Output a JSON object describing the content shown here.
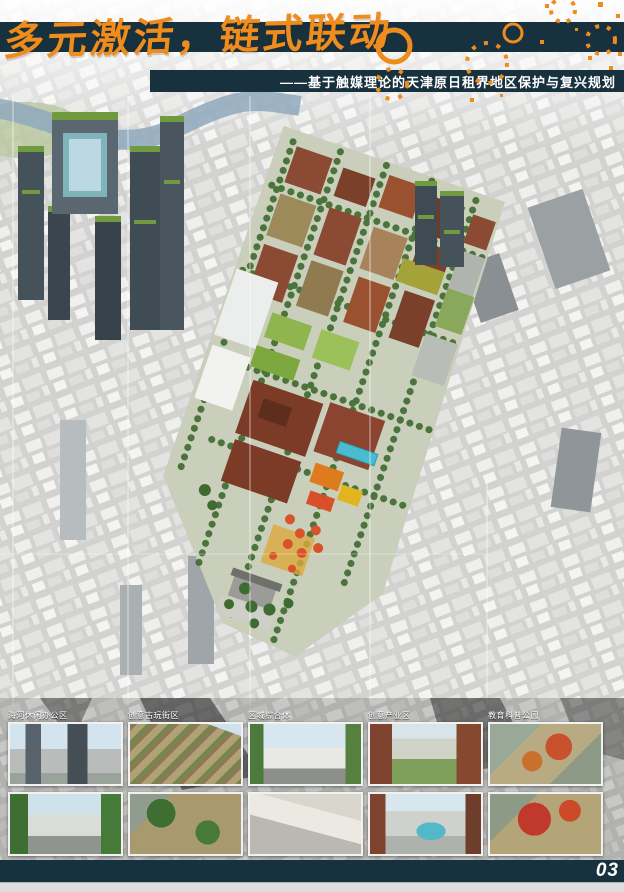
{
  "header": {
    "title": "多元激活，链式联动",
    "subtitle": "——基于触媒理论的天津原日租界地区保护与复兴规划"
  },
  "footer": {
    "page_number": "03"
  },
  "thumbnails": {
    "rows": [
      {
        "items": [
          {
            "label": "海河休闲办公区"
          },
          {
            "label": "创意古玩街区"
          },
          {
            "label": "区域综合体"
          },
          {
            "label": "创意产业区"
          },
          {
            "label": "教育科普公园"
          }
        ]
      },
      {
        "items": [
          {
            "label": ""
          },
          {
            "label": ""
          },
          {
            "label": ""
          },
          {
            "label": ""
          },
          {
            "label": ""
          }
        ]
      }
    ]
  },
  "colors": {
    "navy": "#17313e",
    "orange": "#ef8c1e",
    "background": "#d2d2d1",
    "text_white": "#ffffff",
    "river_blue": "#8fa9bd",
    "tree_green": "#3e6b2f",
    "brick_red": "#8a4a33",
    "pool_teal": "#49bcd0"
  }
}
